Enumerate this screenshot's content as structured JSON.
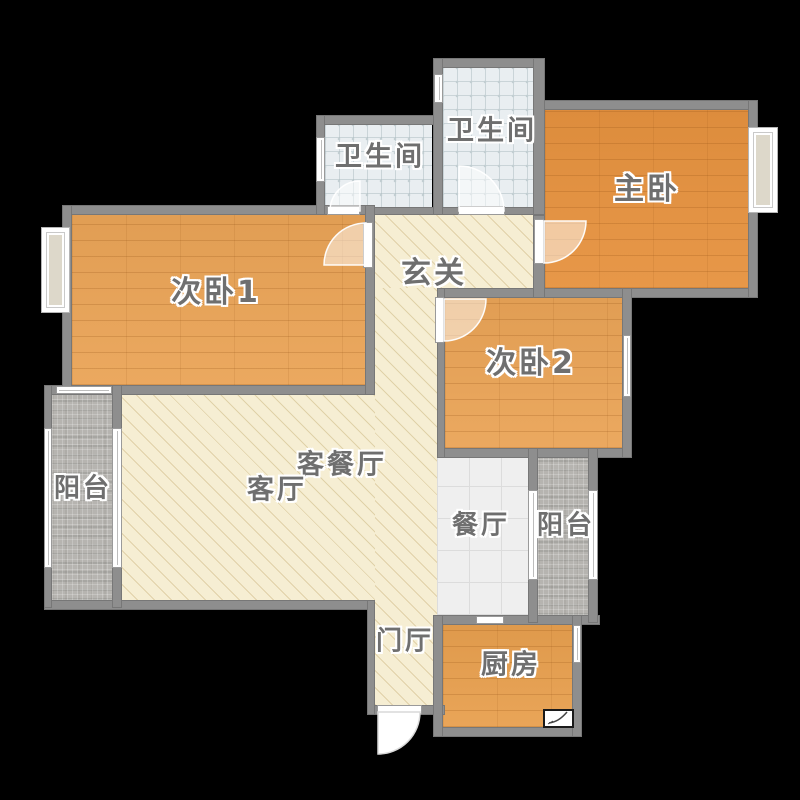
{
  "floorplan": {
    "type": "apartment-floor-plan",
    "background": "#000000",
    "colors": {
      "wall": "#8e8e8e",
      "wood-master": "#e6923f",
      "wood-bed": "#eaa457",
      "wood-kitchen": "#e8a04f",
      "tile-bath": "#e9eef1",
      "tile-bath-dot": "#c2ced2",
      "floor-beige": "#f6eed3",
      "beige-line": "#e0d1a8",
      "balcony-tile": "#b6b4b0",
      "dining-tile": "#efefef",
      "label": "#6f6f6f",
      "bay-fill": "#ddd8ca"
    },
    "labels": {
      "bathroom1": "卫生间",
      "bathroom2": "卫生间",
      "master_bedroom": "主卧",
      "bedroom1": "次卧1",
      "entrance_hall": "玄关",
      "bedroom2": "次卧2",
      "living_dining_room": "客餐厅",
      "living_room": "客厅",
      "balcony_left": "阳台",
      "dining_room": "餐厅",
      "balcony_right": "阳台",
      "foyer": "门厅",
      "kitchen": "厨房"
    }
  }
}
